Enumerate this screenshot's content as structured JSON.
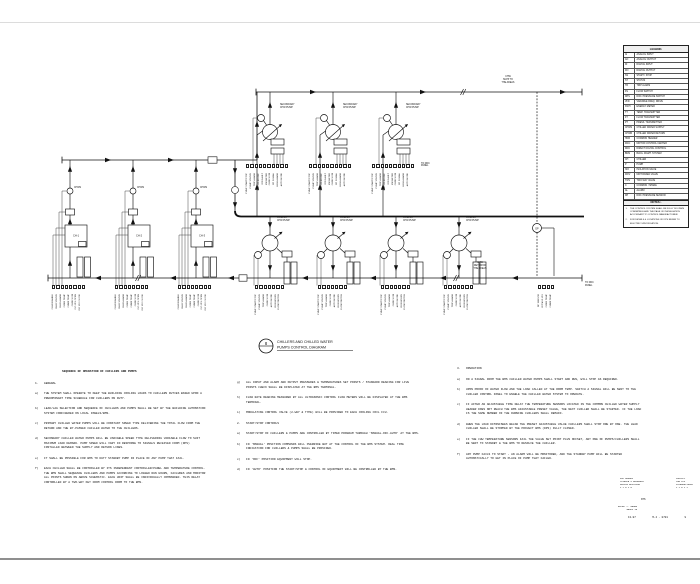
{
  "sheet": {
    "callout_number": "8",
    "title_line1": "CHILLERS AND CHILLED WATER",
    "title_line2": "PUMPS CONTROL DIAGRAM"
  },
  "diagram": {
    "labels": {
      "supply": "CHW\nSUPP TO\nTHE AREAS",
      "return": "CHW\nRET FROM\nTHE AREAS",
      "secondary_pump": "SECONDARY\nCHW PUMP",
      "primary_pump": "PRIMARY\nCHW PUMP",
      "chws": "CHWS",
      "dp": "DP",
      "to_ddc": "TO DDC\nPANEL"
    },
    "chillers": [
      {
        "tag": "CH-1"
      },
      {
        "tag": "CH-2"
      },
      {
        "tag": "CH-3"
      }
    ],
    "io_secondary": [
      "PUMP START/STOP",
      "PUMP STATUS",
      "TRIP ALARM",
      "VFD SPEED REF",
      "VFD FAULT",
      "KW METER",
      "CHW FLOW",
      "DP SIGNAL",
      "HIGH ALARM",
      "AUTO MODE"
    ],
    "io_chiller": [
      "CHLR ENABLE",
      "CHLR STATUS",
      "CHLR ALARM",
      "CHWS TEMP",
      "CHWR TEMP",
      "CHW FLOW",
      "ISO VLV OPEN",
      "ISO VLV CLOSE"
    ],
    "io_primary": [
      "PUMP START/STOP",
      "PUMP STATUS",
      "TRIP ALARM",
      "CHW FLOW",
      "AUTO MODE",
      "RUN HOURS",
      "FLOW SWITCH"
    ],
    "io_right": [
      "DP SENSOR",
      "BYPASS VLV",
      "CHWS TEMP",
      "CHWR TEMP"
    ]
  },
  "legend": {
    "title": "LEGEND.",
    "items": [
      {
        "abbr": "AI",
        "desc": "ANALOG INPUT"
      },
      {
        "abbr": "AO",
        "desc": "ANALOG OUTPUT"
      },
      {
        "abbr": "DI",
        "desc": "DIGITAL INPUT"
      },
      {
        "abbr": "DO",
        "desc": "DIGITAL OUTPUT"
      },
      {
        "abbr": "SS",
        "desc": "START / STOP"
      },
      {
        "abbr": "ST",
        "desc": "STATUS"
      },
      {
        "abbr": "TR",
        "desc": "TRIP ALARM"
      },
      {
        "abbr": "FS",
        "desc": "FLOW SWITCH"
      },
      {
        "abbr": "DPS",
        "desc": "DIFF. PRESSURE SWITCH"
      },
      {
        "abbr": "VFD",
        "desc": "VARIABLE FREQ. DRIVE"
      },
      {
        "abbr": "KWH",
        "desc": "ENERGY METER"
      },
      {
        "abbr": "TT",
        "desc": "TEMP. TRANSMITTER"
      },
      {
        "abbr": "FT",
        "desc": "FLOW TRANSMITTER"
      },
      {
        "abbr": "PT",
        "desc": "PRESS. TRANSMITTER"
      },
      {
        "abbr": "CHWS",
        "desc": "CHILLED WATER SUPPLY"
      },
      {
        "abbr": "CHWR",
        "desc": "CHILLED WATER RETURN"
      },
      {
        "abbr": "HDR",
        "desc": "COMMON HEADER"
      },
      {
        "abbr": "MCC",
        "desc": "MOTOR CONTROL CENTER"
      },
      {
        "abbr": "DDC",
        "desc": "DIRECT DIGITAL CONTROL"
      },
      {
        "abbr": "BMS",
        "desc": "BLDG. MGMT. SYSTEM"
      },
      {
        "abbr": "CH",
        "desc": "CHILLER"
      },
      {
        "abbr": "P",
        "desc": "PUMP"
      },
      {
        "abbr": "ISO",
        "desc": "ISOLATION VALVE"
      },
      {
        "abbr": "MOV",
        "desc": "MOTORIZED VALVE"
      },
      {
        "abbr": "TWV",
        "desc": "TWO WAY VALVE"
      },
      {
        "abbr": "C",
        "desc": "COMMON / SPARE"
      },
      {
        "abbr": "AL",
        "desc": "ALARM"
      },
      {
        "abbr": "DP",
        "desc": "DIFF. PRESSURE SENSOR"
      }
    ],
    "notes_title": "NOTES:-",
    "notes": [
      {
        "tag": "1.",
        "text": "THE CONTROL SYSTEM SHALL BE FULLY DDC/BMS COMPATIBLE AND THE PAGE OF INSTALLATION ACCORDANT TO CONTROL MANUFACTURER."
      },
      {
        "tag": "2.",
        "text": "FOR DETAILS & LOCATIONS OF DPS REFER TO ELECTRIC SPECIFICATION."
      }
    ]
  },
  "sequence": {
    "col1": {
      "title": "SEQUENCE OF OPERATION OF CHILLERS AND PUMPS",
      "items": [
        {
          "tag": "1.",
          "text": "GENERAL"
        },
        {
          "tag": "a)",
          "text": "THE SYSTEM SHALL OPERATE TO KEEP THE BUILDING COOLING LOADS TO CHILLERS DUTIES BASED UPON A PREDOMINANT TIME SCHEDULE FOR CHILLERS ON DUTY."
        },
        {
          "tag": "b)",
          "text": "LEAD/LAG SELECTION AND SEQUENCE OF CHILLERS AND PUMPS SHALL BE SET BY THE BUILDING AUTOMATION SYSTEM CONFIGURED ON LOCAL PANELS/BMS."
        },
        {
          "tag": "c)",
          "text": "PRIMARY CHILLED WATER PUMPS WILL BE CONSTANT SPEED TYPE DELIVERING THE TOTAL FLOW FROM THE RETURN AND THE BY-PASSED CHILLED WATER TO THE CHILLERS."
        },
        {
          "tag": "d)",
          "text": "SECONDARY CHILLED WATER PUMPS WILL BE VARIABLE SPEED TYPE DELIVERING VARIABLE FLOW TO SUIT MAXIMUM LOAD DEMAND. PUMP SPEED WILL VARY IN RESPONSE TO SIGNALS RECEIVED FROM (DPS) INSTALLED BETWEEN THE SUPPLY AND RETURN LINES."
        },
        {
          "tag": "e)",
          "text": "IT SHALL BE POSSIBLE FOR BMS TO DUTY STANDBY PUMP IN PLACE OF ANY PUMP THAT FAIL."
        },
        {
          "tag": "f)",
          "text": "EACH CHILLER SHALL BE CONTROLLED BY ITS INDEPENDENT CONTROLLER/PANEL AND TEMPERATURE CONTROL. THE BMS SHALL SEQUENCE CHILLERS AND PUMPS ACCORDING TO LOGGED RUN HOURS, FAILURES AND MONITOR ALL POINTS SHOWN ON ABOVE SCHEMATIC. EACH UNIT SHALL BE INDIVIDUALLY COMMANDED. THIS RELAY CONTROLLED BY A TWO-WAY KEY FROM CONTROL ROOM TO THE BMS."
        }
      ]
    },
    "col2": {
      "items": [
        {
          "tag": "g)",
          "text": "ALL INPUT AND ALARM AND OUTPUT PRESSURES & TEMPERATURES SET POINTS / STANDARD READING FOR LIVE POINTS CHECK SHALL BE DISPLAYED AT THE BMS TERMINAL."
        },
        {
          "tag": "h)",
          "text": "FLOW RATE READING MEASURED BY ALL ULTRASONIC CONTROL FLOW METERS WILL BE DISPLAYED AT THE BMS TERMINAL."
        },
        {
          "tag": "i)",
          "text": "MODULATING CONTROL VALVE (2-WAY & TYPE) WILL BE PROVIDED TO EACH COOLING COIL FCU."
        },
        {
          "tag": "2.",
          "text": "START/STOP CONTROLS"
        },
        {
          "tag": "a)",
          "text": "START/STOP OF CHILLERS & PUMPS ARE CONTROLLED BY TIMED PROGRAM THROUGH 'MANUAL-OFF-AUTO' AT THE BMS."
        },
        {
          "tag": "b)",
          "text": "IN 'MANUAL' POSITION COMMANDS WILL OVERRIDE BUT AT THE CONTROL OF THE BMS SYSTEM. REAL TIME INDICATION FOR CHILLERS & PUMPS SHALL BE PROVIDED."
        },
        {
          "tag": "c)",
          "text": "IN 'OFF' POSITION EQUIPMENT WILL STOP."
        },
        {
          "tag": "d)",
          "text": "IN 'AUTO' POSITION THE START/STOP & CONTROL OF EQUIPMENT WILL BE CONTROLLED BY THE BMS."
        }
      ]
    },
    "col3": {
      "items": [
        {
          "tag": "3.",
          "text": "OPERATION"
        },
        {
          "tag": "a)",
          "text": "ON A SIGNAL FROM THE BMS CHILLED WATER PUMPS SHALL START AND RUN, WILL STOP AS REQUIRED."
        },
        {
          "tag": "b)",
          "text": "UPON PROOF OF WATER FLOW AND THE LOAD CALLED AT THE ROOM TEMP. SWITCH A SIGNAL WILL BE SENT TO THE CHILLER CONTROL PANEL TO ENABLE THE CHILLED WATER SYSTEM TO OPERATE."
        },
        {
          "tag": "c)",
          "text": "IF AFTER AN ADJUSTABLE TIME DELAY THE TEMPERATURE SENSORS LOCATED IN THE COMMON CHILLED WATER SUPPLY HEADER DOES NOT REACH THE BMS ADJUSTABLE PRESET VALUE, THE NEXT CHILLER SHALL BE STARTED. IF THE LOAD IS THE SAME NUMBER OF THE RUNNING CHILLERS SHALL REMAIN."
        },
        {
          "tag": "d)",
          "text": "WHEN THE LOAD DIMINISHES BELOW THE PRESET ADJUSTABLE VALUE CHILLERS SHALL STOP ONE BY ONE. THE LEAD CHILLER SHALL BE STOPPED BY THE PROJECT BMS (DPS) FULLY CLOSED."
        },
        {
          "tag": "e)",
          "text": "IF THE CHW TEMPERATURE SENSORS FAIL THE VALUE SET POINT PLUS OFFSET, ANY ONE OF PUMPS/CHILLERS SHALL BE SENT TO STANDBY & THE BMS TO RESOLVE THE CHILLER."
        },
        {
          "tag": "f)",
          "text": "ANY PUMP FAILS TO START - AN ALARM WILL BE MONITORED, AND THE STANDBY PUMP WILL BE STARTED AUTOMATICALLY TO GET IN PLACE OF PUMP THAT FAILED."
        }
      ]
    }
  },
  "titleblock": {
    "block_a": "KOC AHMADI\nSCIENCE & RESEARCH\nOFFICE BUILDING\n1 2 0 1 5",
    "block_b": "CONSULT\nTHE W+P\nINTERNATIONAL\n1 1 0 1 1",
    "scale": "NTS",
    "approved_label": "APPRD",
    "approved_name": "L. AHMED\nGROUP 1A",
    "doc_no_left": "13-97",
    "doc_no_mid": "M-4 - 0701",
    "doc_no_right": "9"
  }
}
